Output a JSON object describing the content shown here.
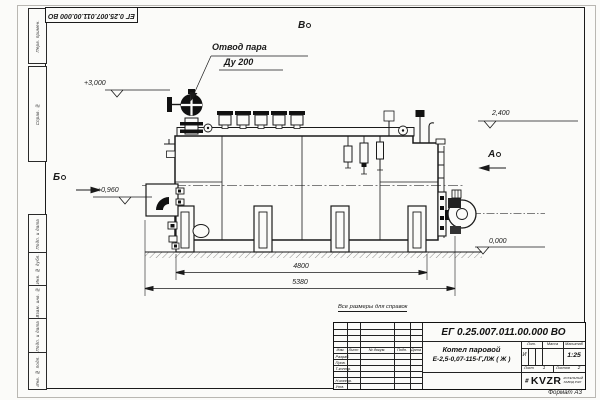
{
  "sheet": {
    "top_doc_number": "ЕГ 0.25.007.011.00.000  ВО",
    "format_note": "Формат А3",
    "margin_labels": [
      "Перв. примен.",
      "Справ. №",
      "Подп. и дата",
      "Инв. № дубл.",
      "Взам. инв. №",
      "Подп. и дата",
      "Инв. № подл."
    ]
  },
  "drawing": {
    "callout_line1": "Отвод пара",
    "callout_line2": "Ду 200",
    "elev_top": "+3,000",
    "elev_right": "2,400",
    "elev_left": "+0,960",
    "elev_zero": "0,000",
    "view_b": "Б",
    "view_v": "В",
    "view_a": "А",
    "dim_4800": "4800",
    "dim_5380": "5380",
    "note": "Все размеры для справок"
  },
  "title_block": {
    "doc_number": "ЕГ 0.25.007.011.00.000  ВО",
    "name_line1": "Котел паровой",
    "name_line2": "Е-2,5-0,07-115-Г,ЛЖ ( Ж )",
    "col_izm": "Изм.",
    "col_list": "Лист",
    "col_ndok": "№ докум.",
    "col_podp": "Подп.",
    "col_data": "Дата",
    "row_razrab": "Разраб.",
    "row_prov": "Пров.",
    "row_tkontr": "Т.контр.",
    "row_nkontr": "Н.контр.",
    "row_utv": "Утв.",
    "lit_label": "Лит.",
    "lit_value": "И",
    "massa_label": "Масса",
    "masshtab_label": "Масштаб",
    "masshtab_value": "1:25",
    "list_label": "Лист",
    "list_value": "1",
    "listov_label": "Листов",
    "listov_value": "2",
    "logo": "KVZR",
    "logo_line1": "КОТЕЛЬНЫЙ",
    "logo_line2": "ЗАВОД РЭП"
  }
}
